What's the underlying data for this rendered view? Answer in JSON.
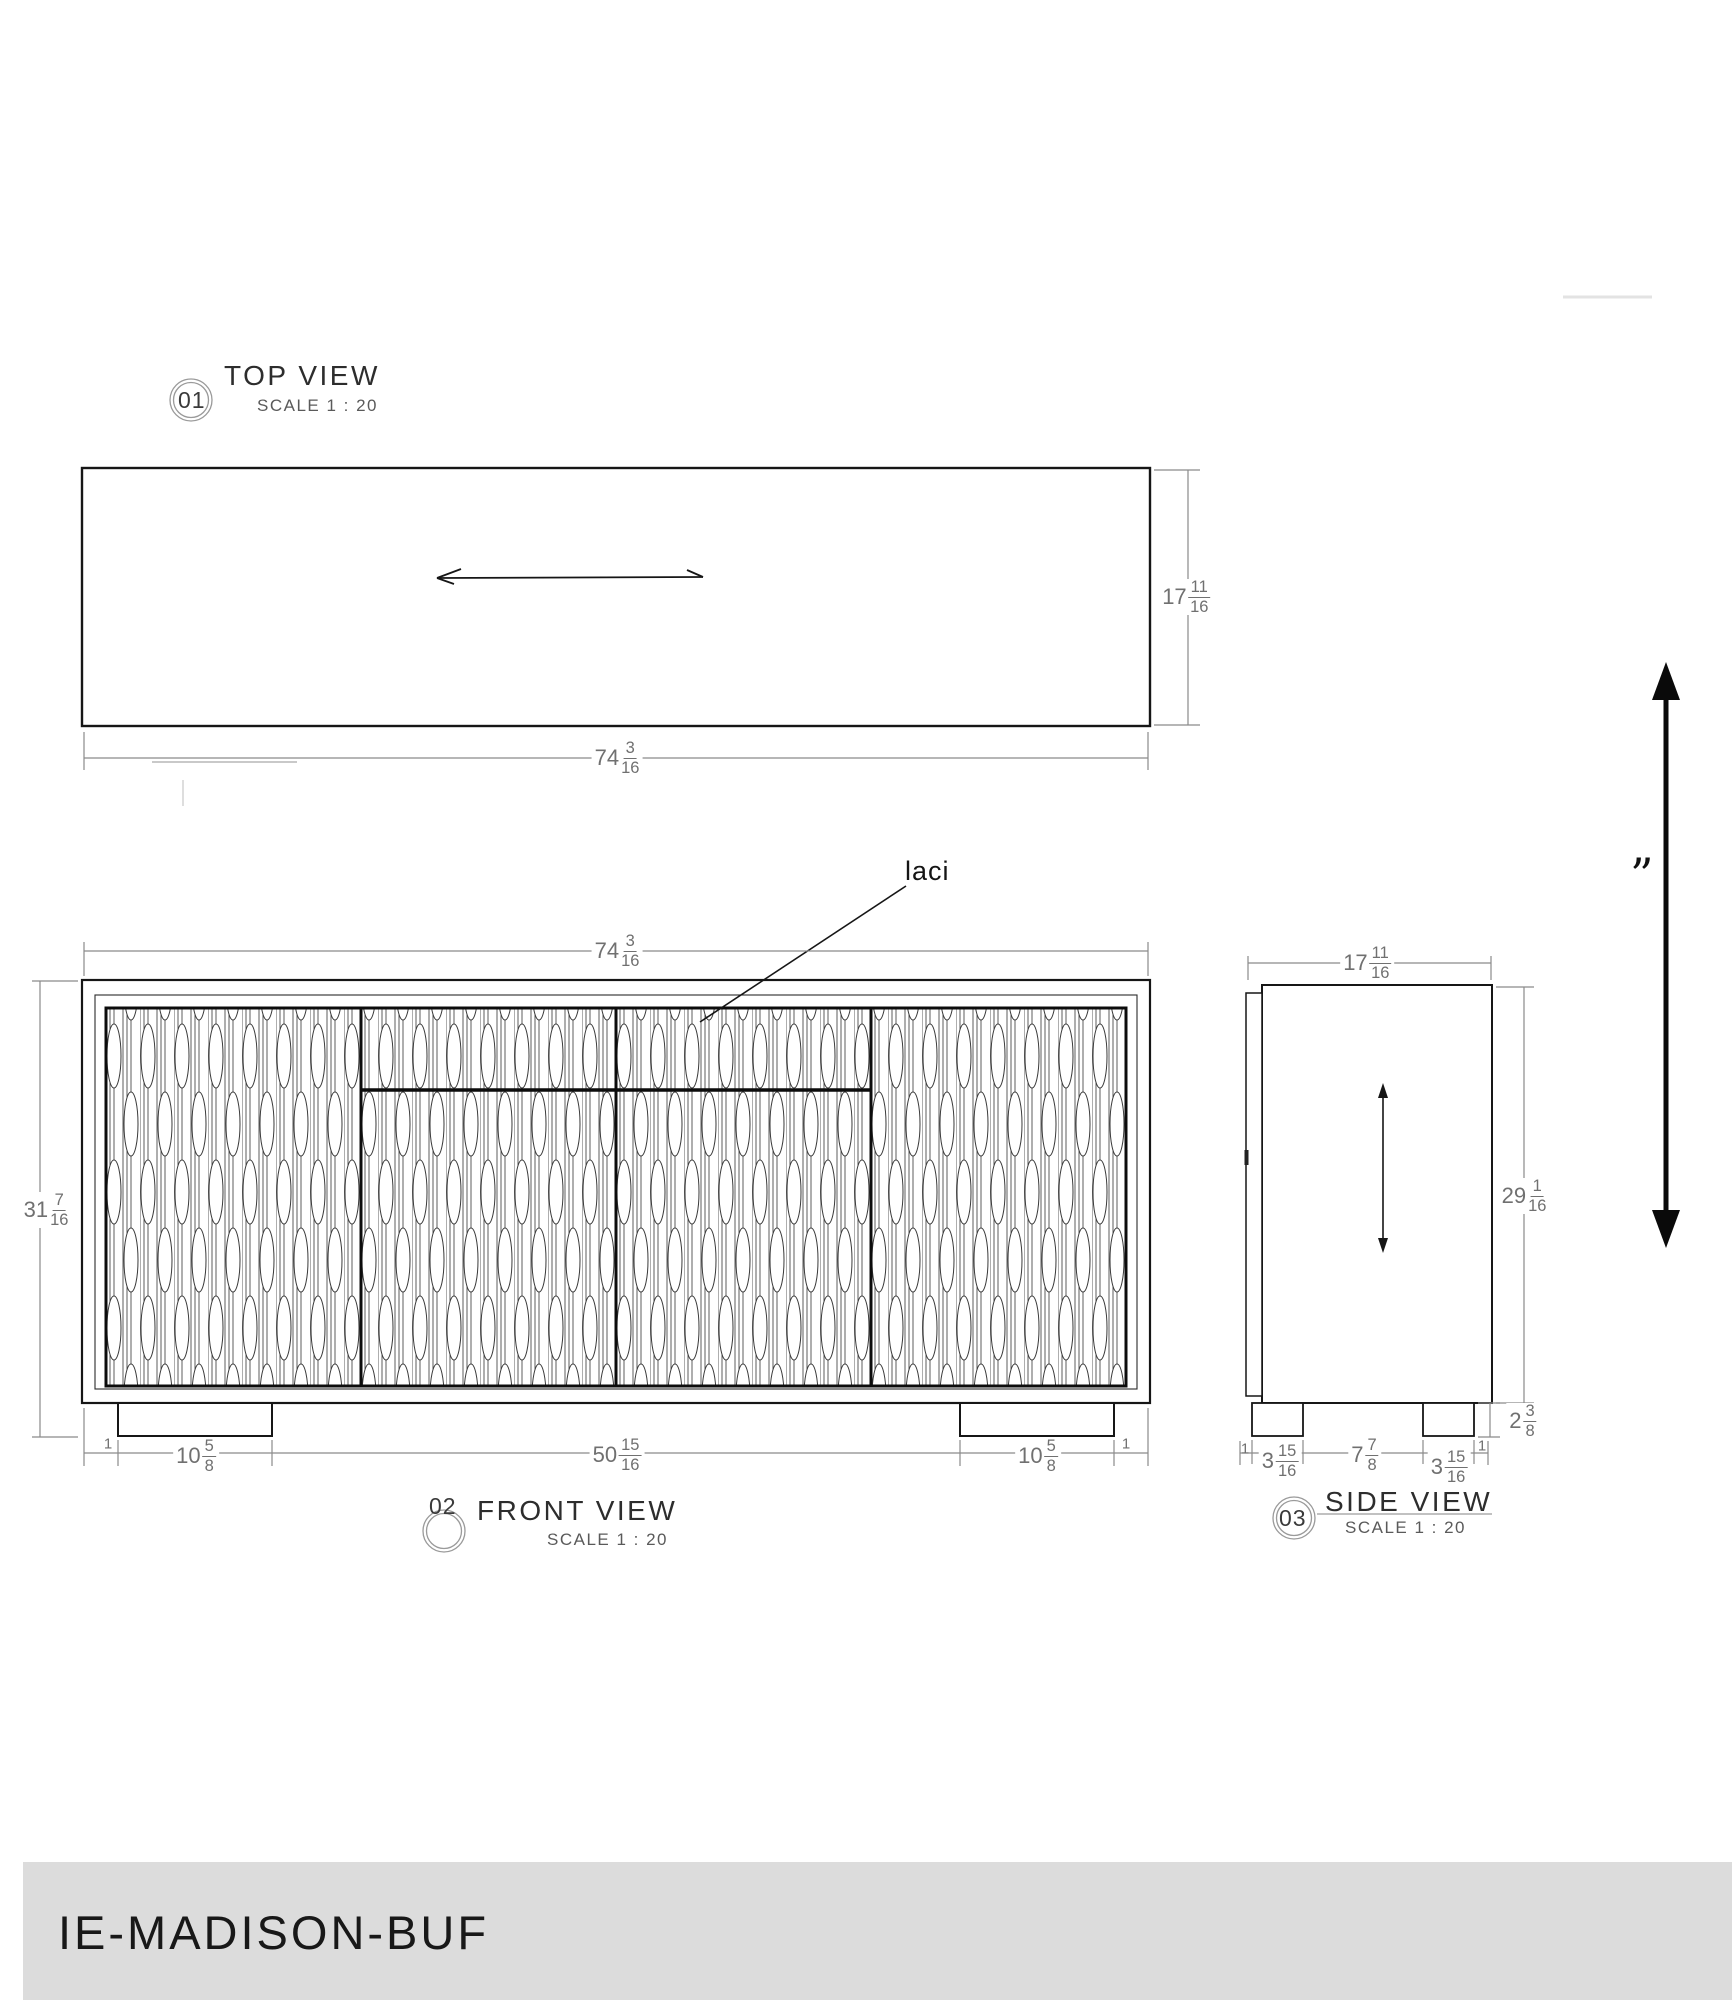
{
  "labels": {
    "top": {
      "num": "01",
      "title": "TOP VIEW",
      "scale": "SCALE 1 : 20"
    },
    "front": {
      "num": "02",
      "title": "FRONT VIEW",
      "scale": "SCALE 1 : 20"
    },
    "side": {
      "num": "03",
      "title": "SIDE VIEW",
      "scale": "SCALE 1 : 20"
    }
  },
  "annotations": {
    "drawer_label": "laci",
    "quote_mark": "”"
  },
  "dims": {
    "top_depth": {
      "w": "17",
      "n": "11",
      "d": "16"
    },
    "top_width": {
      "w": "74",
      "n": "3",
      "d": "16"
    },
    "front_width": {
      "w": "74",
      "n": "3",
      "d": "16"
    },
    "front_height": {
      "w": "31",
      "n": "7",
      "d": "16"
    },
    "front_inset_l": {
      "w": "1"
    },
    "front_foot_l": {
      "w": "10",
      "n": "5",
      "d": "8"
    },
    "front_span": {
      "w": "50",
      "n": "15",
      "d": "16"
    },
    "front_foot_r": {
      "w": "10",
      "n": "5",
      "d": "8"
    },
    "front_inset_r": {
      "w": "1"
    },
    "side_depth": {
      "w": "17",
      "n": "11",
      "d": "16"
    },
    "side_height": {
      "w": "29",
      "n": "1",
      "d": "16"
    },
    "side_foot_h": {
      "w": "2",
      "n": "3",
      "d": "8"
    },
    "side_inset_l": {
      "w": "1"
    },
    "side_foot_l": {
      "w": "3",
      "n": "15",
      "d": "16"
    },
    "side_span": {
      "w": "7",
      "n": "7",
      "d": "8"
    },
    "side_foot_r": {
      "w": "3",
      "n": "15",
      "d": "16"
    },
    "side_inset_r": {
      "w": "1"
    }
  },
  "footer": {
    "code": "IE-MADISON-BUF"
  },
  "colors": {
    "footer_bg": "#dcdcdc",
    "line": "#161616",
    "dim_line": "#8a8a8a",
    "dim_text": "#707070"
  }
}
